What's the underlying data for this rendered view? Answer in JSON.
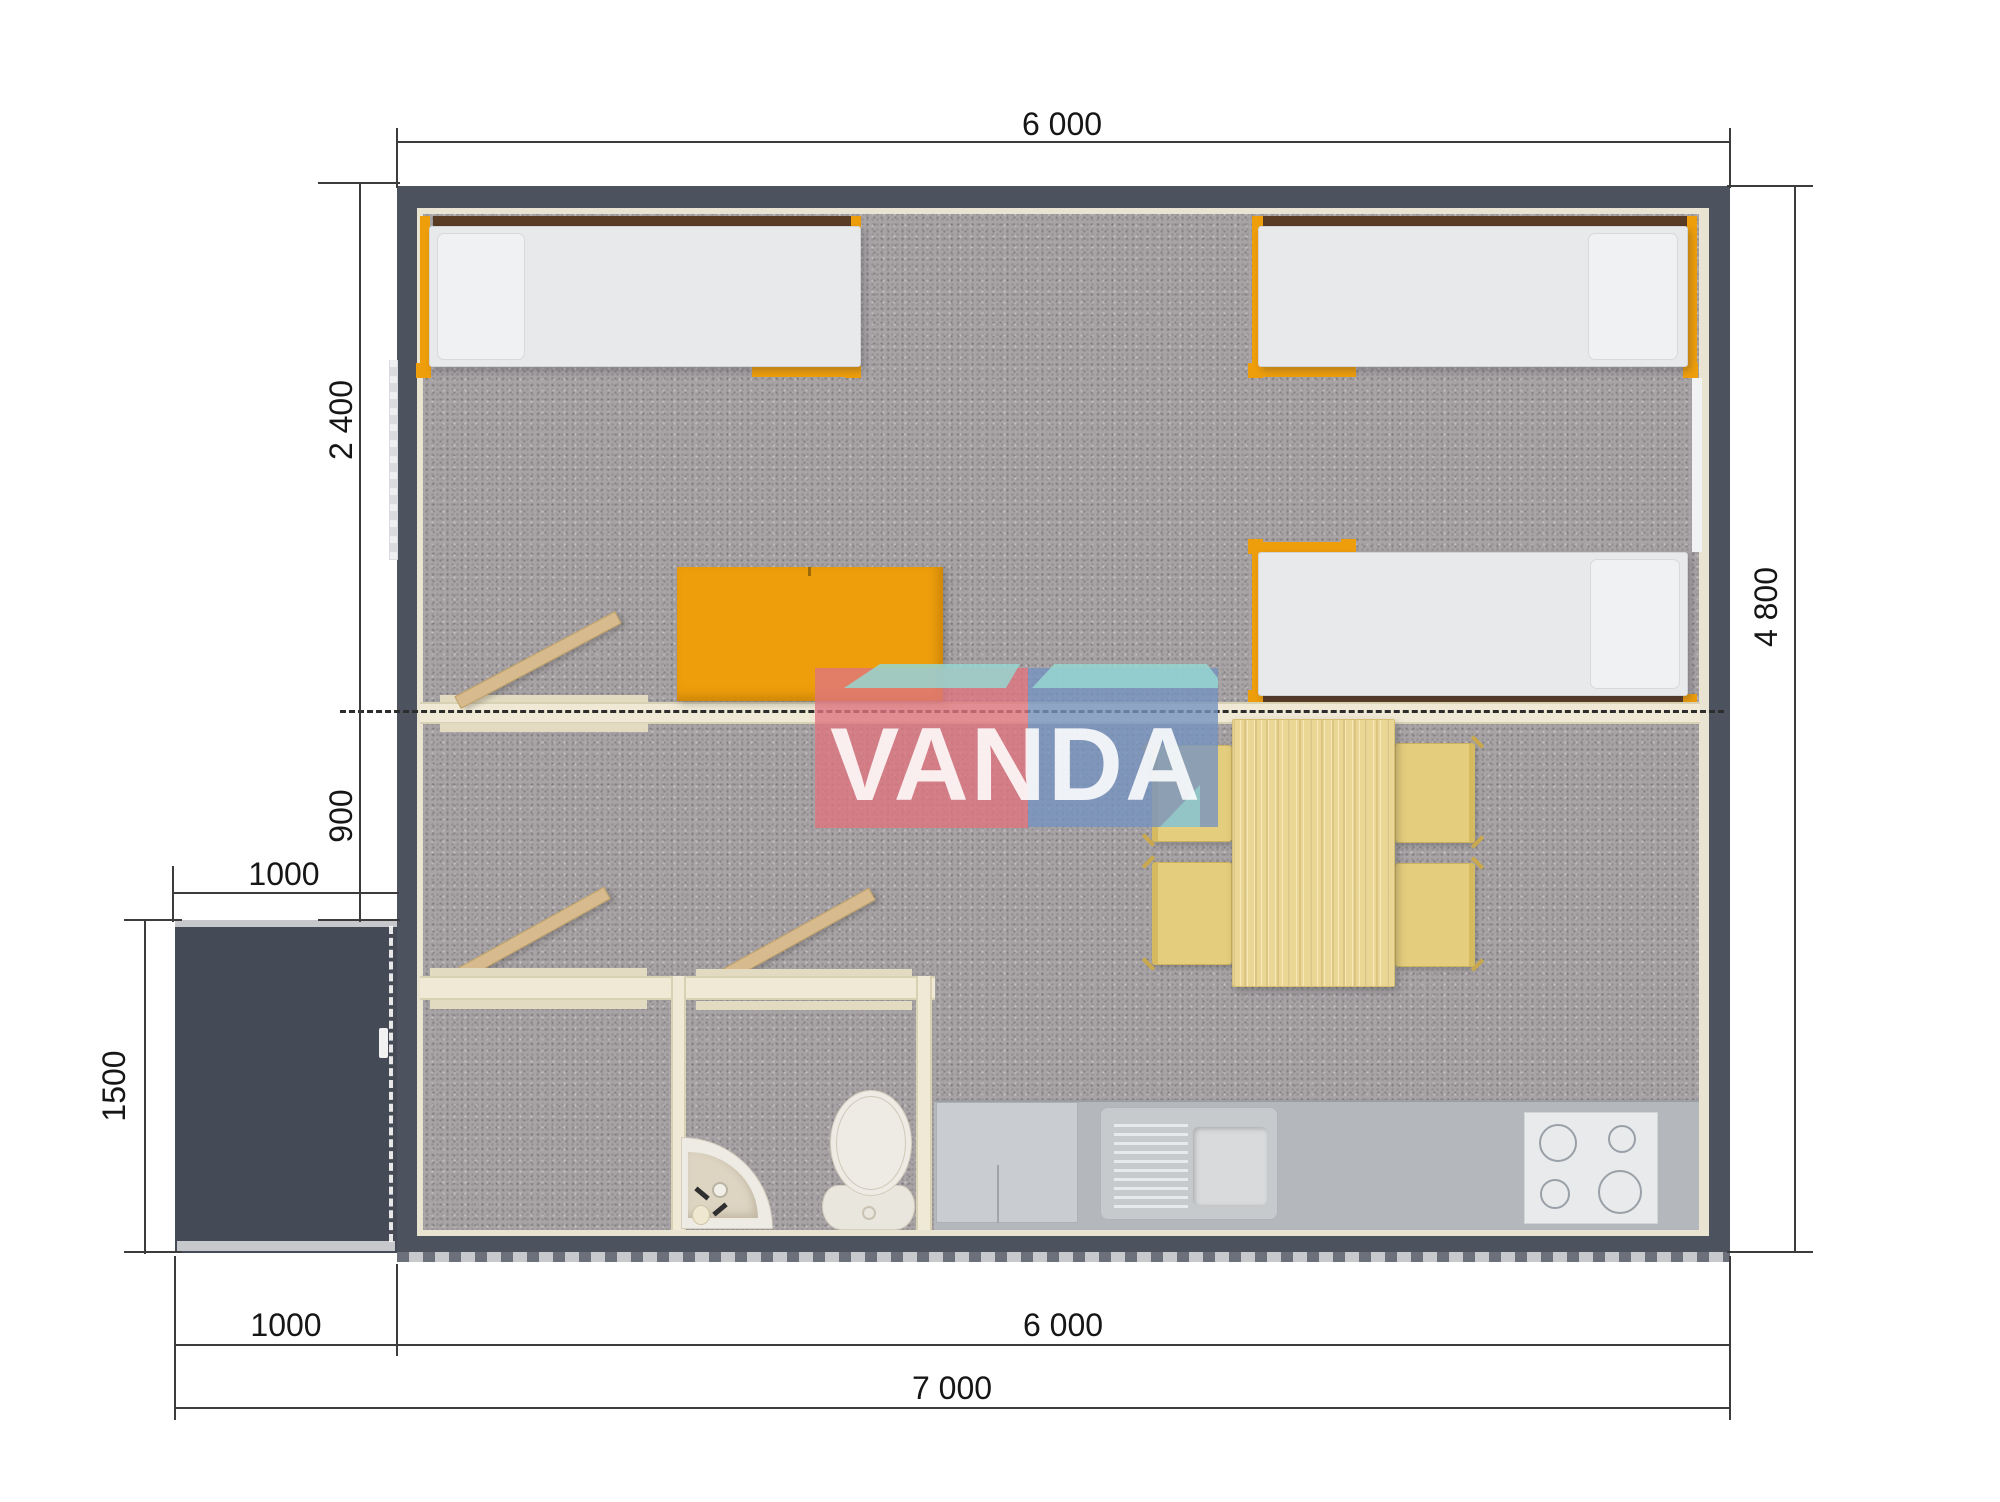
{
  "logo": {
    "text": "VANDA"
  },
  "dimensions": {
    "top_width": "6 000",
    "bedroom_depth": "2 400",
    "hall_depth": "900",
    "porch_width_top": "1000",
    "porch_depth": "1500",
    "total_depth": "4 800",
    "bottom_porch_width": "1000",
    "bottom_main_width": "6 000",
    "bottom_total_width": "7 000"
  },
  "colors": {
    "wall": "#4d525f",
    "floor_carpet": "#a8a4a6",
    "interior_lining": "#e9e4d2",
    "partition_cream": "#efe9d5",
    "accent_orange": "#ee9e0b",
    "headboard_brown": "#5a3b24",
    "wood_table": "#ead795",
    "chair_yellow": "#e4cd7c",
    "kitchen_counter": "#b4b7bb",
    "logo_pink": "#de7680",
    "logo_blue": "#7694c0",
    "logo_teal": "#96d6d0",
    "dimension_line": "#3c3c3c"
  }
}
